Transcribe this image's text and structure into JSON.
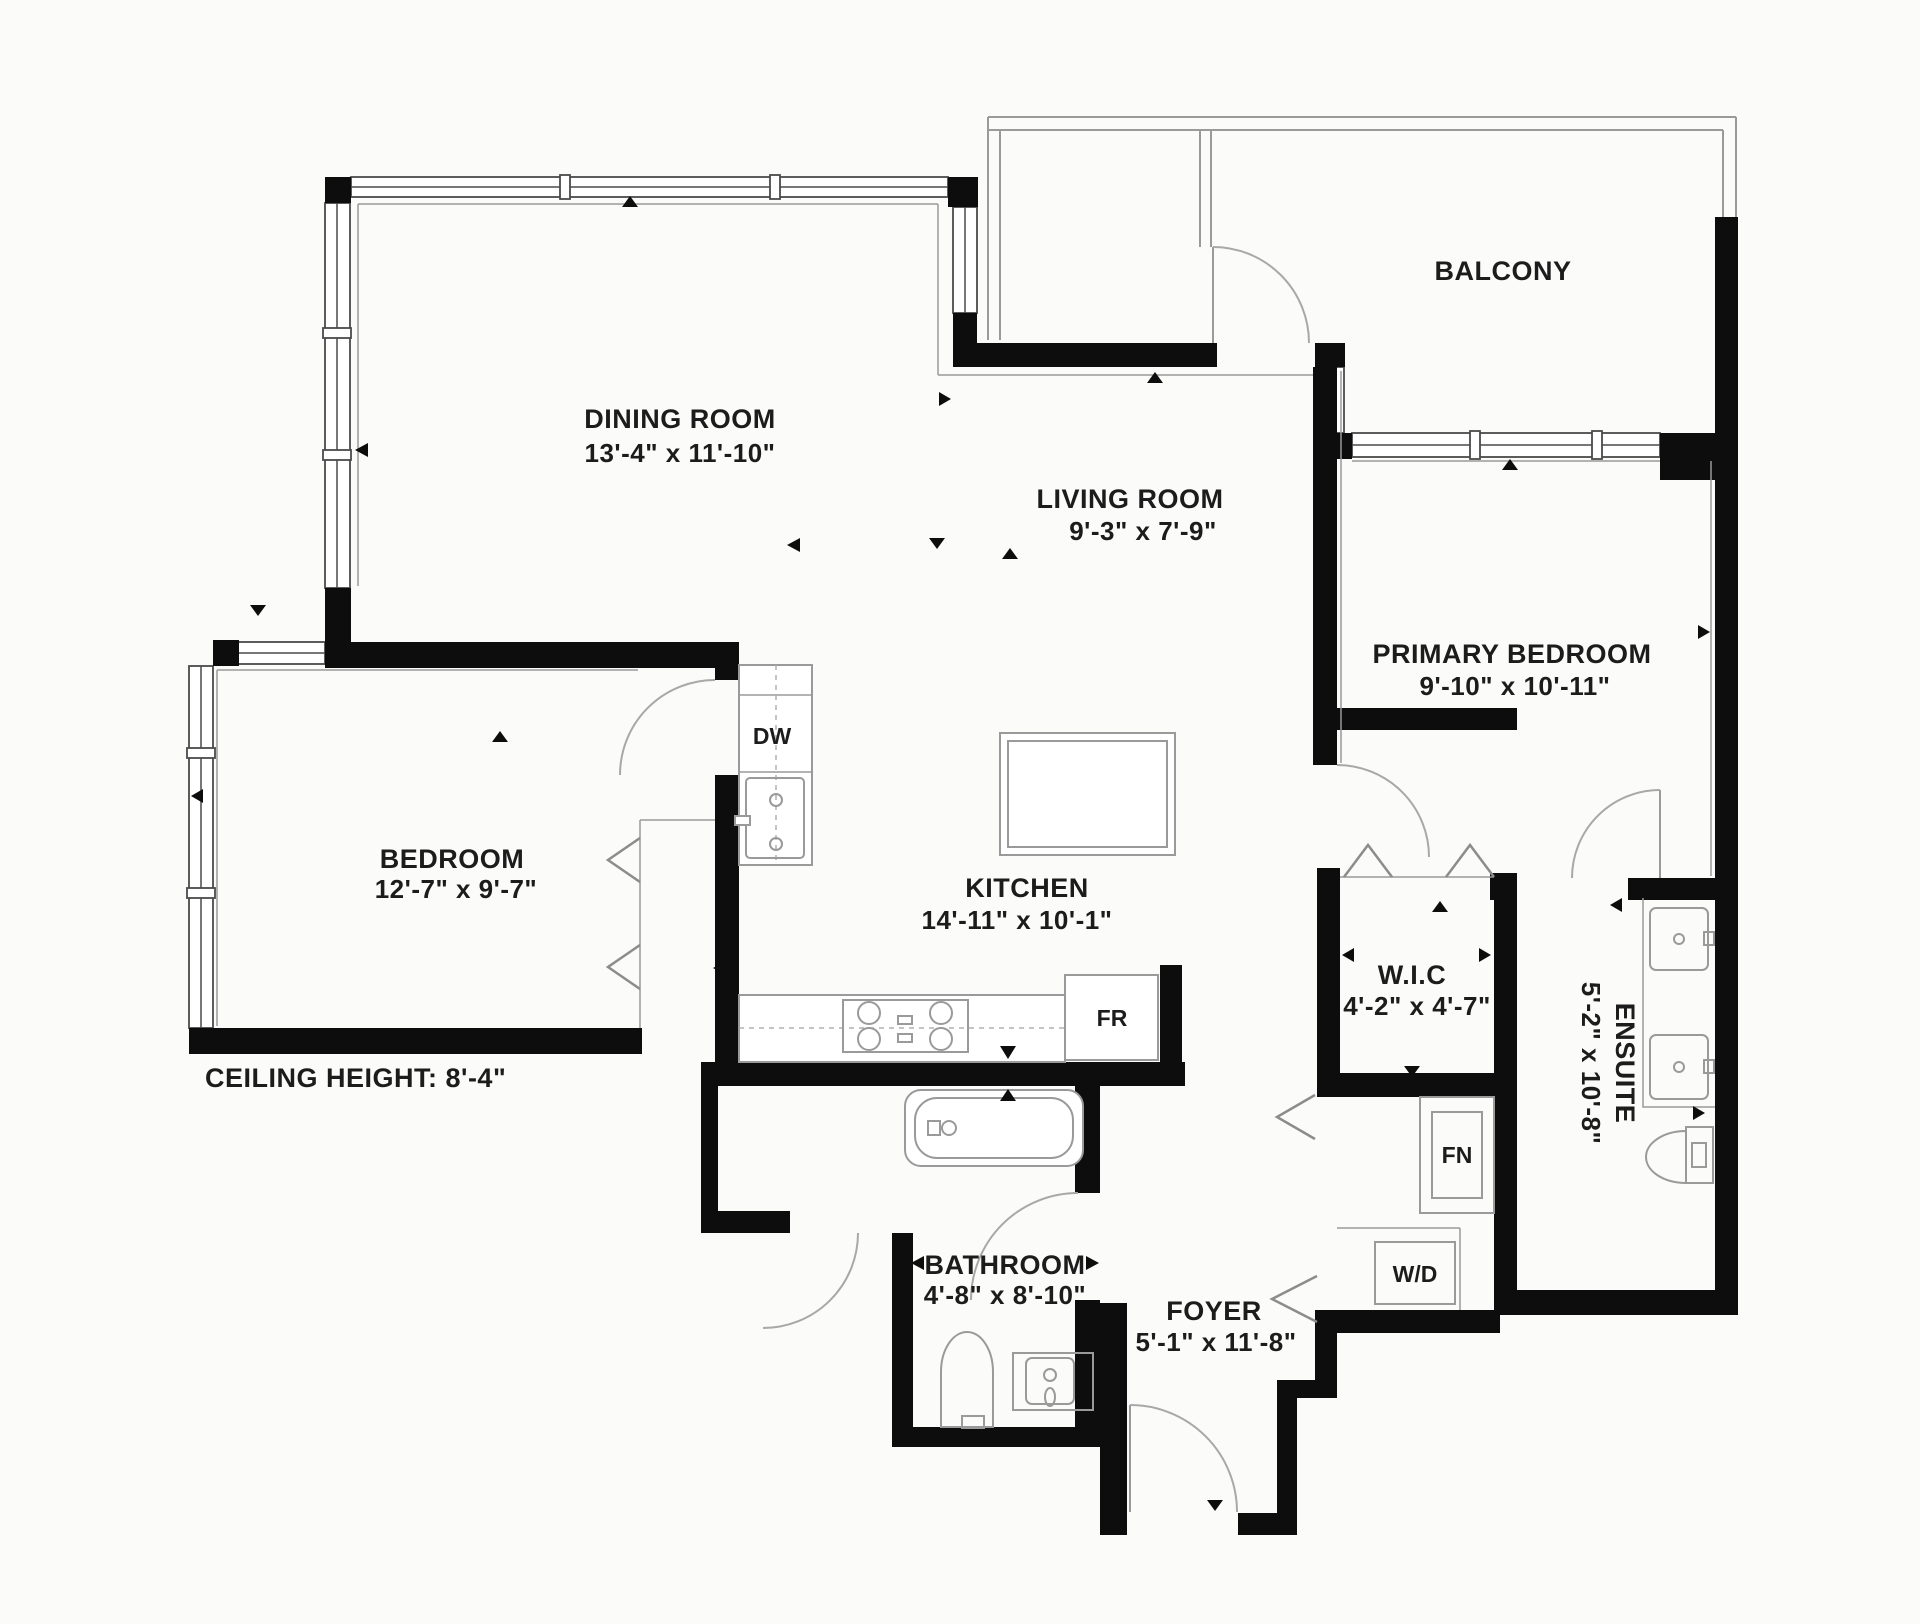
{
  "page": {
    "type": "residential floor plan",
    "background_color": "#fbfbfa",
    "wall_color": "#0d0d0d",
    "thin_line_color": "#9a9a9a",
    "text_color": "#1c1c1c"
  },
  "floor_plan": {
    "rooms": [
      {
        "id": "balcony",
        "name": "BALCONY",
        "dimensions": ""
      },
      {
        "id": "dining_room",
        "name": "DINING ROOM",
        "dimensions": "13'-4\" x 11'-10\""
      },
      {
        "id": "living_room",
        "name": "LIVING ROOM",
        "dimensions": "9'-3\" x 7'-9\""
      },
      {
        "id": "primary_bedroom",
        "name": "PRIMARY BEDROOM",
        "dimensions": "9'-10\" x 10'-11\""
      },
      {
        "id": "bedroom",
        "name": "BEDROOM",
        "dimensions": "12'-7\" x 9'-7\""
      },
      {
        "id": "kitchen",
        "name": "KITCHEN",
        "dimensions": "14'-11\" x 10'-1\""
      },
      {
        "id": "walk_in_closet",
        "name": "W.I.C",
        "dimensions": "4'-2\" x 4'-7\""
      },
      {
        "id": "ensuite",
        "name": "ENSUITE",
        "dimensions": "5'-2\" x 10'-8\""
      },
      {
        "id": "bathroom",
        "name": "BATHROOM",
        "dimensions": "4'-8\" x 8'-10\""
      },
      {
        "id": "foyer",
        "name": "FOYER",
        "dimensions": "5'-1\" x 11'-8\""
      }
    ],
    "appliances": {
      "dishwasher": "DW",
      "fridge": "FR",
      "furnace": "FN",
      "washer_dryer": "W/D"
    },
    "note": {
      "ceiling_height": "CEILING HEIGHT: 8'-4\""
    }
  }
}
